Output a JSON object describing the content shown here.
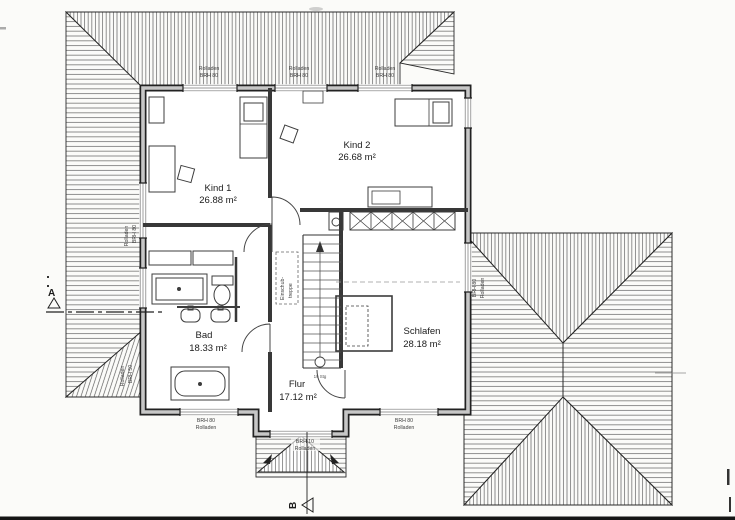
{
  "drawing": {
    "kind": "floor-plan (Dachgeschoss / attic storey, scanned architectural drawing)",
    "rooms": [
      {
        "name": "Kind 1",
        "area": "26.88 m²"
      },
      {
        "name": "Kind 2",
        "area": "26.68 m²"
      },
      {
        "name": "Bad",
        "area": "18.33 m²"
      },
      {
        "name": "Schlafen",
        "area": "28.18 m²"
      },
      {
        "name": "Flur",
        "area": "17.12 m²"
      }
    ],
    "labels": {
      "rolladen": "Rolladen",
      "brh_80": "BRH 80",
      "brh_50": "BRH 50",
      "brh_10": "BRH 10",
      "einschub_line1": "Einschub-",
      "einschub_line2": "treppe",
      "stair_note": "19 Stg"
    },
    "section_markers": {
      "a": "A",
      "b": "B"
    },
    "colors": {
      "paper": "#fbfbf9",
      "ink": "#222222",
      "hatch": "#555555",
      "wall_core": "#c7c7c7"
    }
  }
}
